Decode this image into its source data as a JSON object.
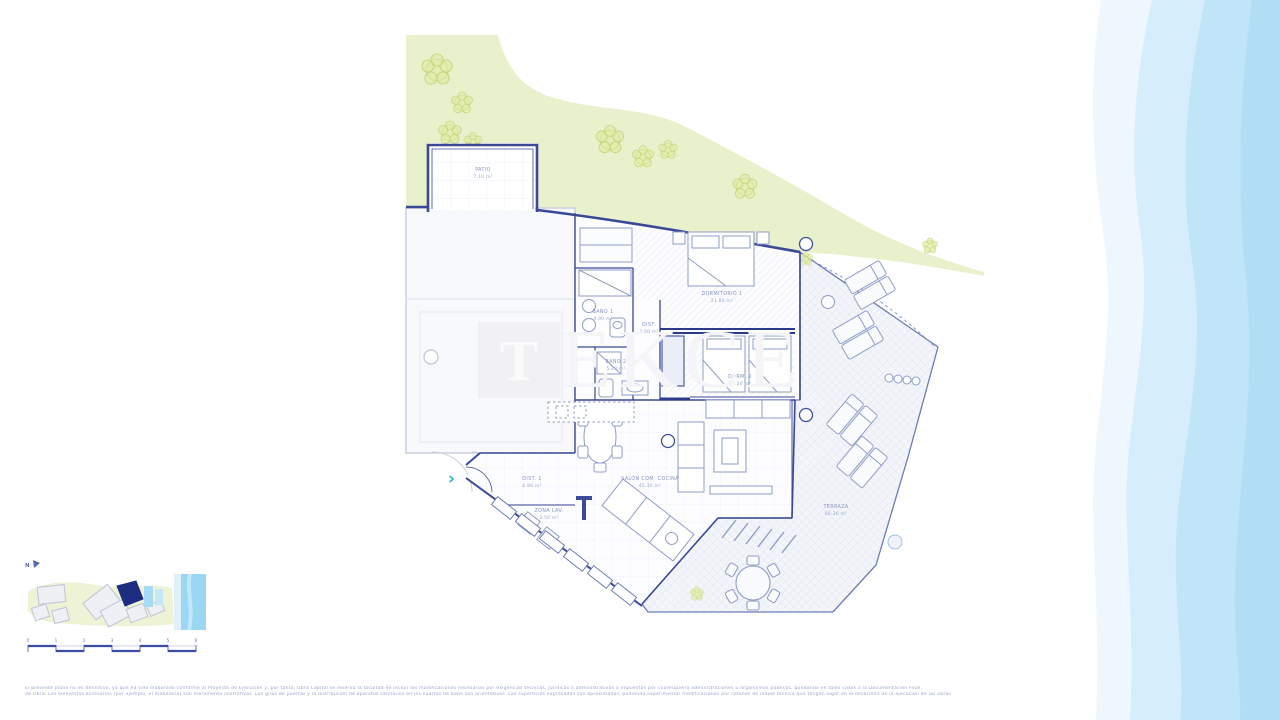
{
  "watermark": {
    "letter": "T",
    "rest": "EKCE"
  },
  "north": {
    "label": "N"
  },
  "rooms": {
    "patio": {
      "name": "PATIO",
      "area": "7.10 m²"
    },
    "dormitorio1": {
      "name": "DORMITORIO 1",
      "area": "21.80 m²"
    },
    "bano1": {
      "name": "BAÑO 1",
      "area": "4.90 m²"
    },
    "dist": {
      "name": "DIST.",
      "area": "2.00 m²"
    },
    "bano2": {
      "name": "BAÑO 2",
      "area": "5.20 m²"
    },
    "dorm2": {
      "name": "DORM. 2",
      "area": "13.20 m²"
    },
    "dist1": {
      "name": "DIST. 1",
      "area": "6.80 m²"
    },
    "zonalav": {
      "name": "ZONA LAV.",
      "area": "3.50 m²"
    },
    "salon": {
      "name": "SALÓN COM. COCINA",
      "area": "45.30 m²"
    },
    "terraza": {
      "name": "TERRAZA",
      "area": "60.30 m²"
    }
  },
  "scalebar": {
    "ticks": [
      "0",
      "1",
      "2",
      "3",
      "4",
      "5",
      "6"
    ]
  },
  "footer": {
    "line1": "El presente plano no es definitivo, ya que ha sido elaborado conforme al Proyecto de Ejecución y, por tanto, Obra Capital se reserva la facultad de incluir las modificaciones necesarias por exigencias técnicas, jurídicas o administrativas o impuestas por cualesquiera administraciones u organismos públicos, quedando en tales casos a la Documentación Final",
    "line2": "de Obra. Los elementos accesorios (por ejemplo, el mobiliario) son meramente ilustrativos. Los giros de puertas y la distribución de aparatos sanitarios en los cuartos de baño son orientativos. Las superficies expresadas son aproximadas, pudiendo experimentar modificaciones por razones de índole técnica que tengan lugar en el desarrollo de la ejecución de las obras"
  },
  "colors": {
    "wall_dark": "#2f3d8f",
    "wall": "#4656a6",
    "furniture_line": "#8e9cc9",
    "label_text": "#8593c4",
    "green_area": "#e9f0cc",
    "tree_stroke": "#c3d87f",
    "sea_band_1": "#eef7fd",
    "sea_band_2": "#d6eefb",
    "sea_band_3": "#c0e4f8",
    "sea_band_4": "#b2def5",
    "entrance_teal": "#2cb3c9",
    "minimap_highlight": "#1d2e80"
  }
}
